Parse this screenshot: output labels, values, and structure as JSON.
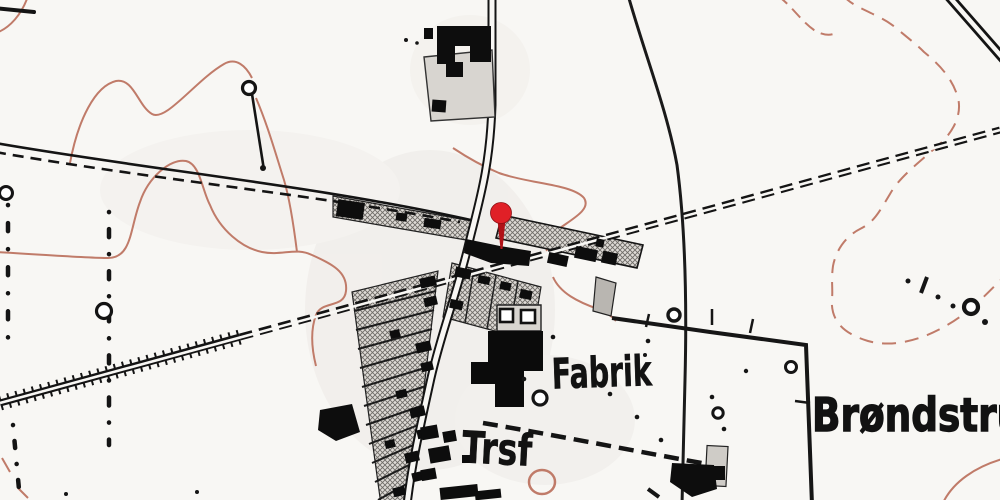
{
  "map": {
    "title": "historical-topographic-map",
    "style": "danish-maalebordsblad-scan",
    "colors": {
      "background": "#f8f7f4",
      "ink": "#121212",
      "contour": "#c07b69",
      "plot_fill": "#dedbd6",
      "yard_fill": "#d8d5d0",
      "pin_head": "#e02027",
      "pin_needle": "#b01218"
    },
    "labels": [
      {
        "id": "fabrik",
        "text": "Fabrik"
      },
      {
        "id": "trsf",
        "text": "Trsf"
      },
      {
        "id": "brondstrup",
        "text": "Brøndstrup"
      }
    ],
    "pin": {
      "name": "map-pin",
      "color": "#e02027",
      "needle_color": "#b01218"
    },
    "features": [
      "railway-with-embankment-ticks",
      "village-main-road",
      "field-road-with-dashed-side",
      "garden-plot-strips",
      "factory-buildings",
      "farm-buildings",
      "parish-boundary-dot-lines",
      "fenced-field-boundary",
      "contour-lines",
      "footpath-dashed",
      "well-circles",
      "windmill-pole-symbol"
    ]
  }
}
